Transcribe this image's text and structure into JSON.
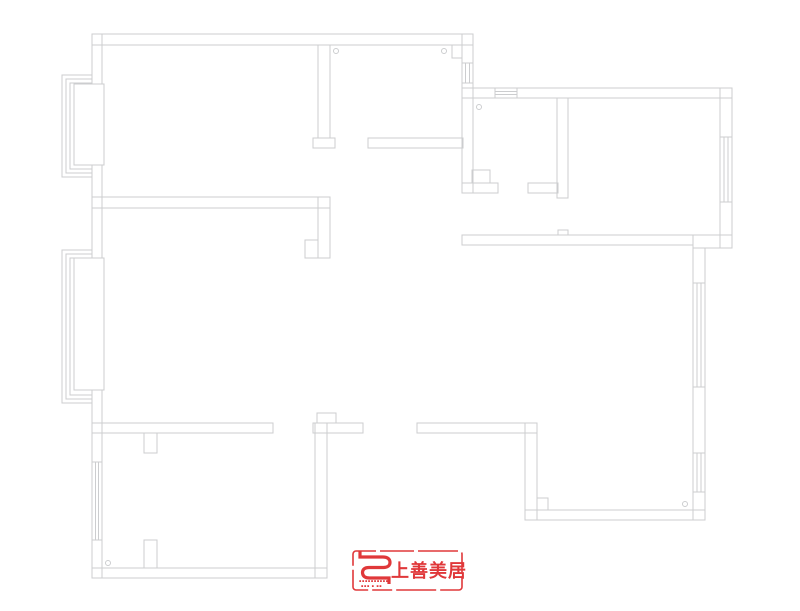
{
  "canvas": {
    "width": 800,
    "height": 611,
    "background": "#ffffff"
  },
  "floorplan": {
    "stroke_color": "#cccdcf",
    "stroke_width": 1,
    "walls": [
      [
        92,
        34,
        10,
        544
      ],
      [
        92,
        34,
        381,
        11
      ],
      [
        462,
        34,
        11,
        159
      ],
      [
        462,
        88,
        270,
        10
      ],
      [
        720,
        88,
        12,
        160
      ],
      [
        462,
        235,
        231,
        10
      ],
      [
        693,
        235,
        39,
        13
      ],
      [
        693,
        248,
        12,
        272
      ],
      [
        525,
        510,
        180,
        10
      ],
      [
        525,
        423,
        12,
        97
      ],
      [
        417,
        423,
        120,
        10
      ],
      [
        313,
        423,
        50,
        10
      ],
      [
        92,
        423,
        181,
        10
      ],
      [
        315,
        423,
        12,
        155
      ],
      [
        92,
        568,
        235,
        10
      ],
      [
        92,
        197,
        238,
        11
      ],
      [
        318,
        197,
        12,
        61
      ],
      [
        305,
        240,
        13,
        18
      ],
      [
        318,
        45,
        12,
        93
      ],
      [
        313,
        138,
        22,
        10
      ],
      [
        368,
        138,
        95,
        10
      ],
      [
        452,
        45,
        10,
        13
      ],
      [
        557,
        98,
        11,
        100
      ],
      [
        462,
        183,
        36,
        10
      ],
      [
        528,
        183,
        30,
        10
      ],
      [
        472,
        170,
        18,
        13
      ],
      [
        558,
        230,
        10,
        5
      ],
      [
        317,
        413,
        19,
        10
      ],
      [
        144,
        433,
        13,
        20
      ],
      [
        144,
        540,
        13,
        28
      ],
      [
        537,
        498,
        11,
        12
      ]
    ],
    "windows": [
      [
        495,
        88,
        22,
        10,
        "h"
      ],
      [
        462,
        63,
        11,
        20,
        "v"
      ],
      [
        720,
        137,
        12,
        65,
        "v"
      ],
      [
        693,
        283,
        12,
        104,
        "v"
      ],
      [
        693,
        453,
        12,
        39,
        "v"
      ],
      [
        92,
        462,
        10,
        78,
        "v"
      ]
    ],
    "bay_windows": [
      {
        "wall_x": 92,
        "brackets": [
          [
            62,
            75,
            177
          ],
          [
            66,
            79,
            173
          ],
          [
            70,
            83,
            169
          ]
        ],
        "pane": [
          74,
          84,
          30,
          81
        ]
      },
      {
        "wall_x": 92,
        "brackets": [
          [
            62,
            250,
            403
          ],
          [
            66,
            254,
            399
          ],
          [
            70,
            258,
            395
          ]
        ],
        "pane": [
          74,
          258,
          30,
          132
        ]
      }
    ],
    "circles": [
      [
        336,
        51
      ],
      [
        444,
        51
      ],
      [
        479,
        107
      ],
      [
        108,
        563
      ],
      [
        685,
        504
      ]
    ],
    "circle_radius": 2.5
  },
  "logo": {
    "color": "#e0383a",
    "text": "上善美居",
    "subtext_row1": "▪▪▪▪▪▪▪▪▪▪",
    "subtext_row2": "▪▪▪ ▪ ▪▪"
  }
}
